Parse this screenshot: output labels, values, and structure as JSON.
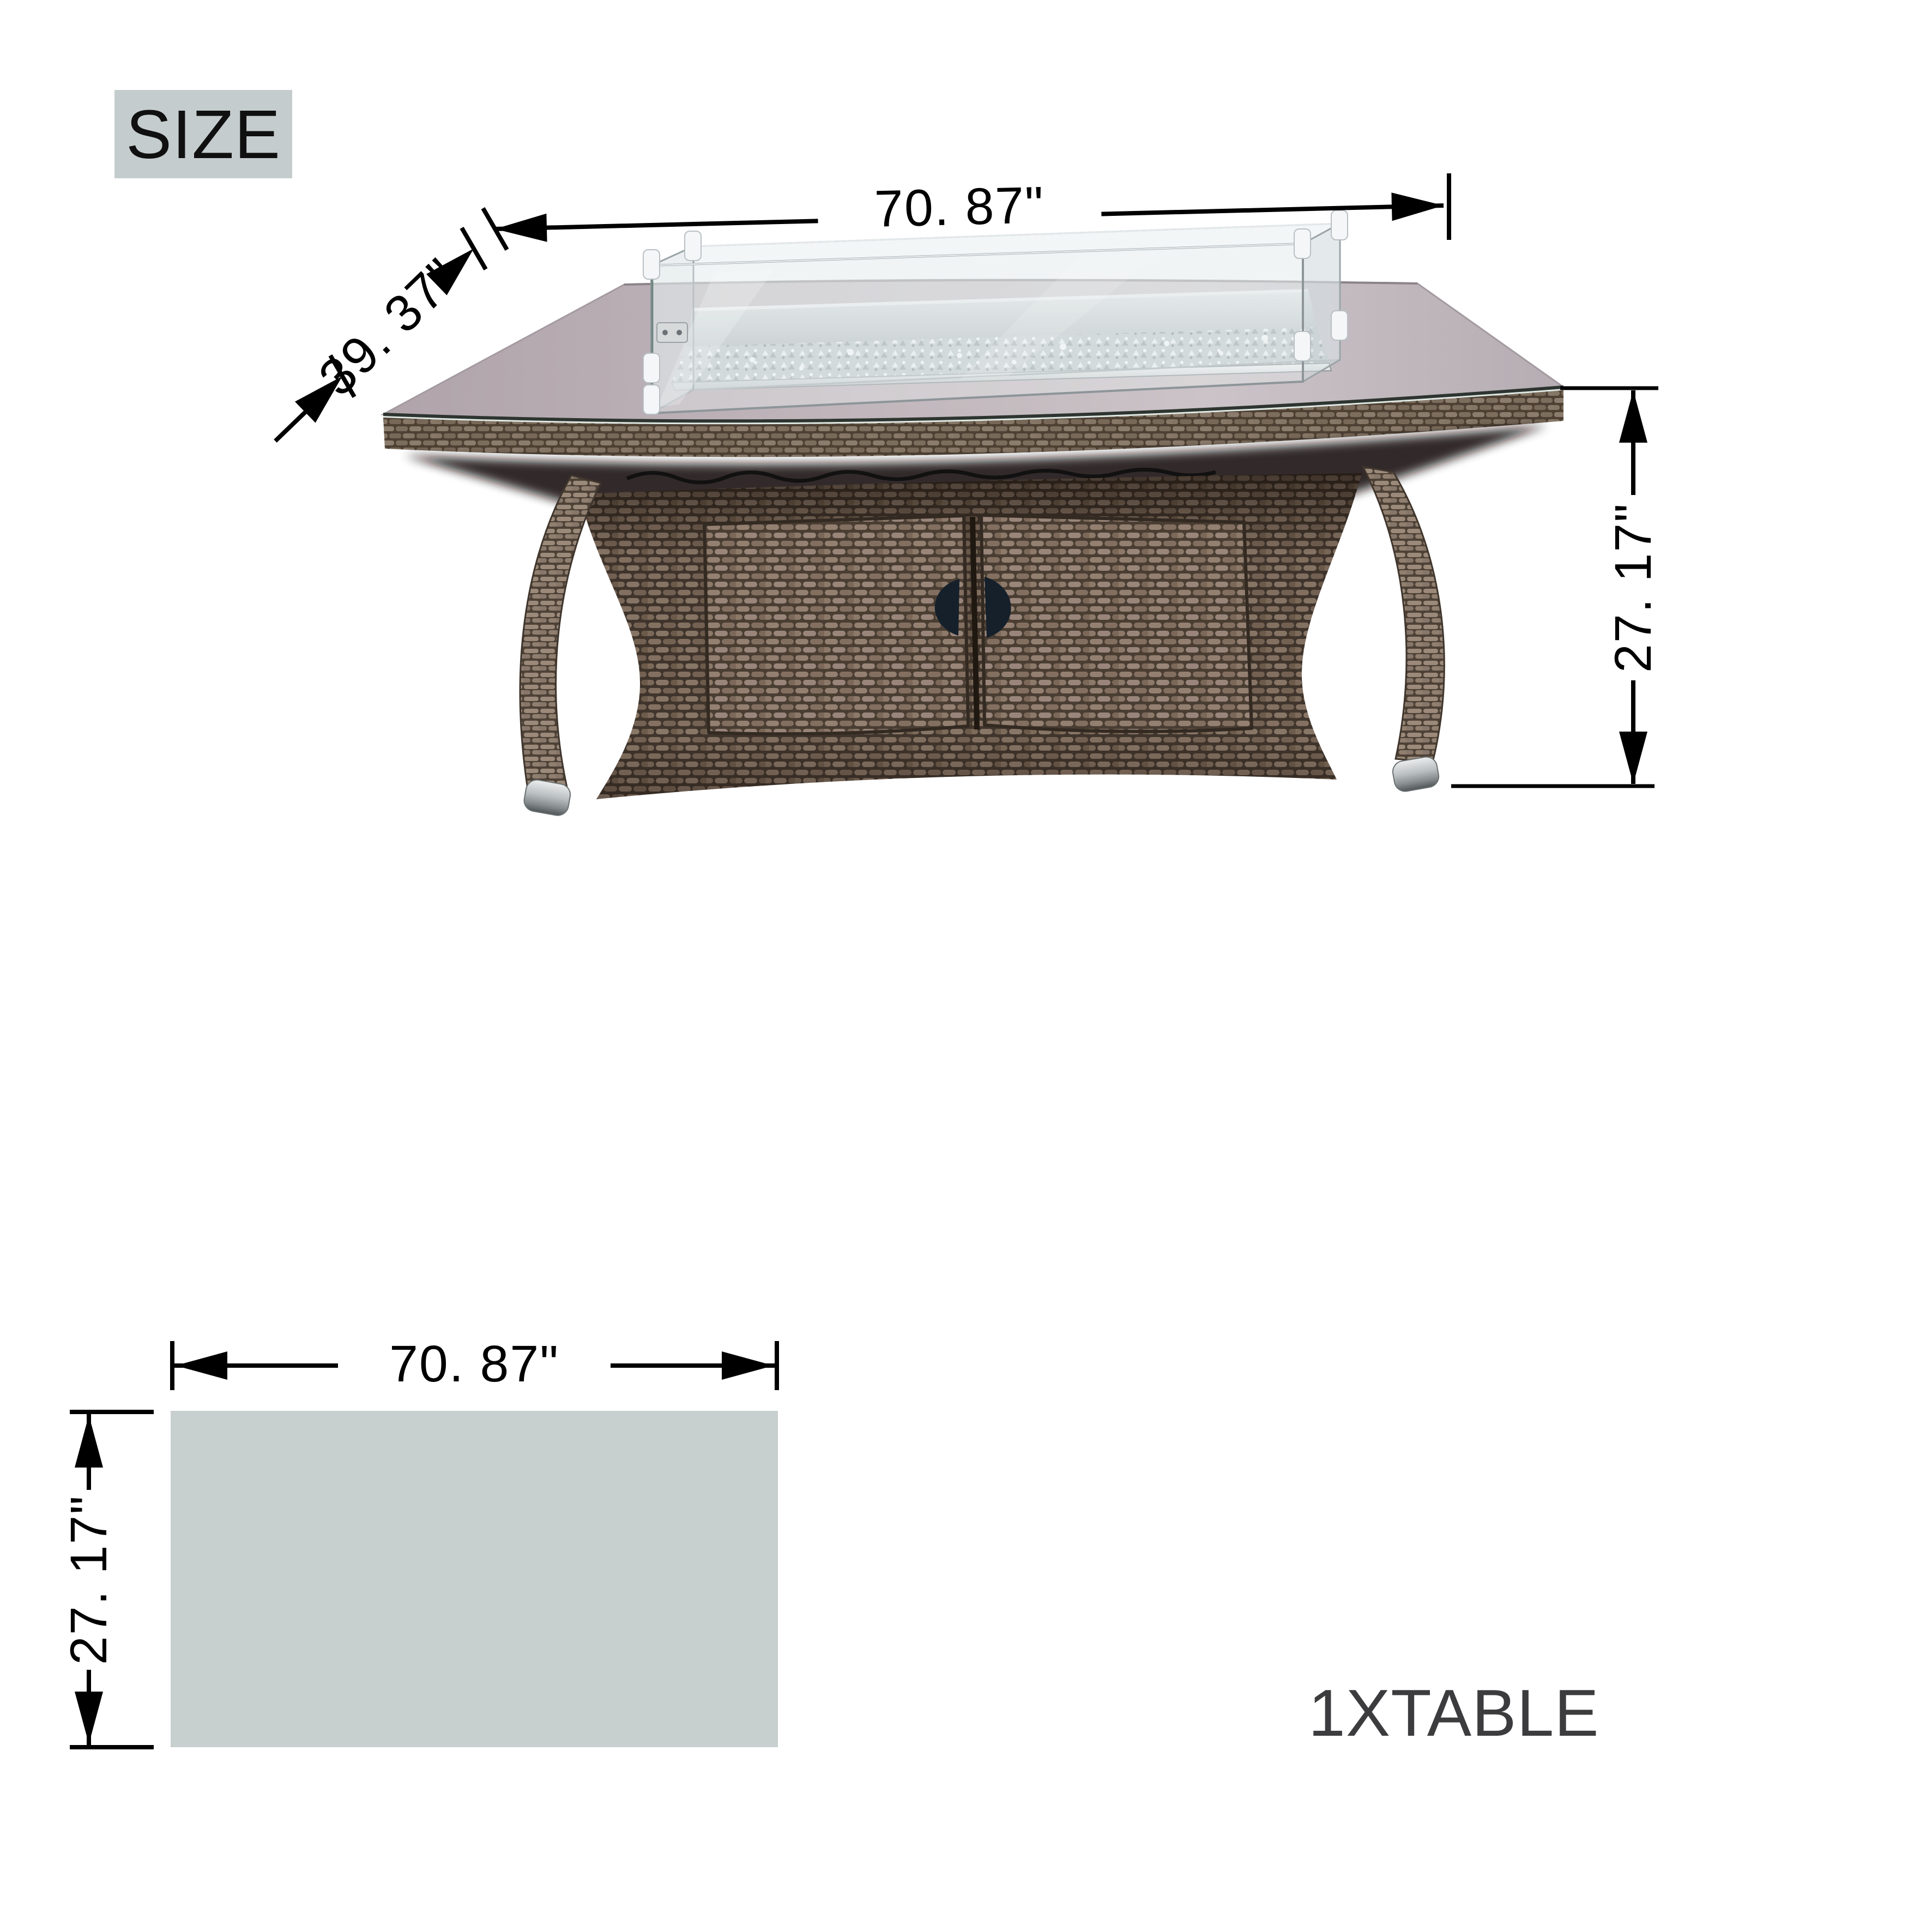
{
  "size_badge": {
    "label": "SIZE",
    "background": "#c5cccd",
    "text_color": "#101010"
  },
  "front_view": {
    "width_label": "70. 87\"",
    "depth_label": "39. 37\"",
    "height_label": "27. 17\"",
    "illustration": "wicker fire pit table with glass wind guard"
  },
  "plan_view": {
    "width_label": "70. 87\"",
    "height_label": "27. 17\"",
    "fill": "#c8cfcf"
  },
  "quantity_label": {
    "text": "1XTABLE",
    "color": "#3c3c3e"
  },
  "annotation_color": "#000000"
}
